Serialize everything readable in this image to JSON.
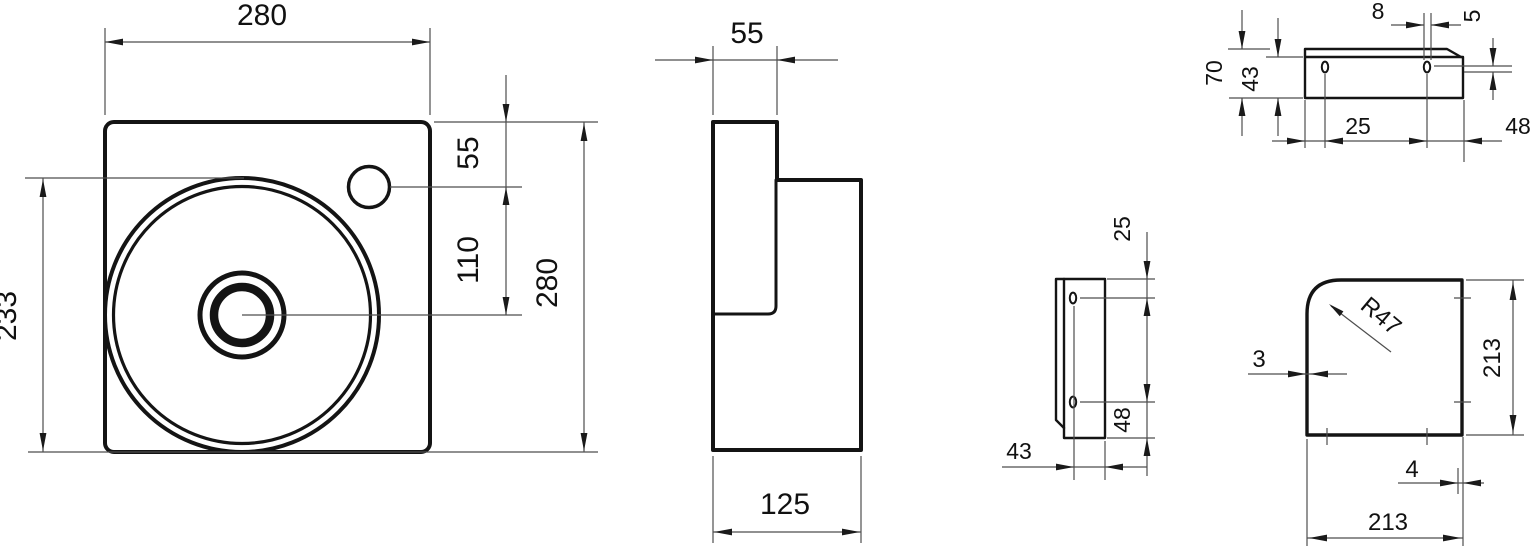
{
  "views": {
    "front": {
      "name": "washbasin-front-view",
      "width_top": "280",
      "height_left": "233",
      "top_to_faucet": "55",
      "faucet_to_drain": "110",
      "height_right": "280"
    },
    "side": {
      "name": "washbasin-side-view",
      "depth_top": "55",
      "depth_total": "125"
    },
    "rail": {
      "name": "mounting-bracket-front-view",
      "slot_width": "8",
      "lip_offset": "5",
      "height_total": "70",
      "height_body": "43",
      "edge_to_slot": "25",
      "slot_to_edge": "48"
    },
    "rail_side": {
      "name": "mounting-bracket-side-view",
      "edge_to_slot": "25",
      "slot_to_edge": "48",
      "width": "43"
    },
    "plan": {
      "name": "washbasin-plan-view",
      "corner_radius": "R47",
      "wall_thickness": "3",
      "side_right": "213",
      "rim_offset": "4",
      "side_bottom": "213"
    }
  },
  "colors": {
    "outline": "#141414",
    "dimension_line": "#4e4e4e",
    "text": "#111111",
    "background": "#ffffff"
  }
}
